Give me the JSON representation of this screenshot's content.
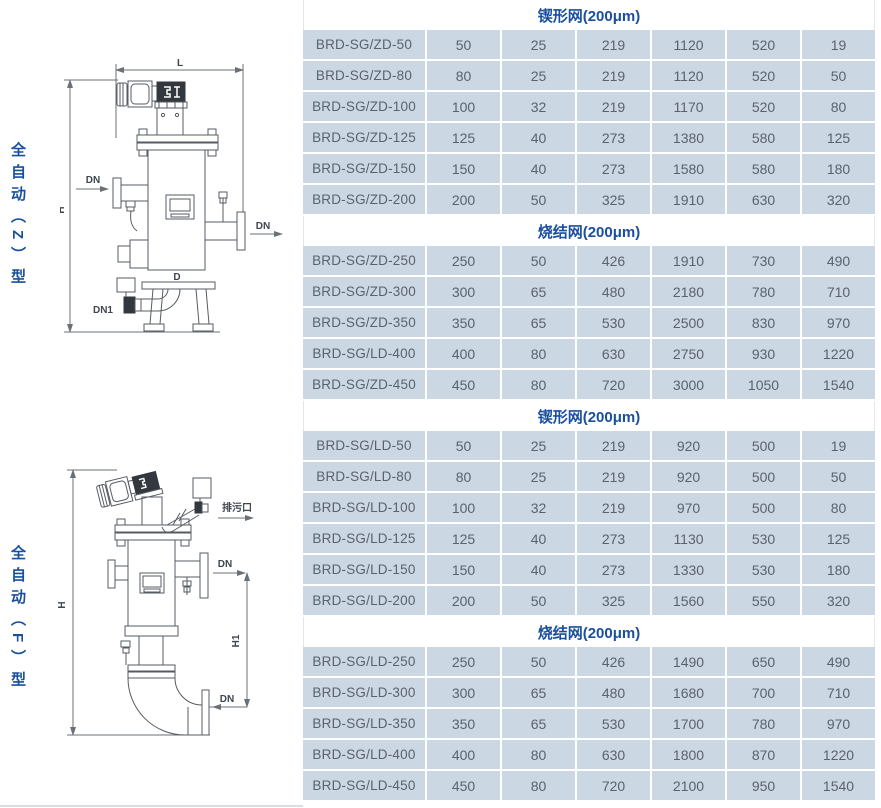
{
  "page": {
    "background": "#ffffff",
    "accent_color": "#1a4f9e",
    "cell_background": "#cbd7e3",
    "cell_text_color": "#5a6270"
  },
  "sidebar": {
    "label_top": "全自动（Z）型",
    "label_bottom": "全自动（F）型"
  },
  "diagram_z": {
    "labels": {
      "L": "L",
      "H": "H",
      "dn_in": "DN",
      "dn_out": "DN",
      "d": "D",
      "dn1": "DN1"
    }
  },
  "diagram_f": {
    "labels": {
      "H": "H",
      "H1": "H1",
      "drain": "排污口",
      "dn_out": "DN",
      "dn_in": "DN"
    }
  },
  "table": {
    "sections": [
      {
        "title": "锲形网(200μm)",
        "rows": [
          {
            "model": "BRD-SG/ZD-50",
            "values": [
              50,
              25,
              219,
              1120,
              520,
              19
            ]
          },
          {
            "model": "BRD-SG/ZD-80",
            "values": [
              80,
              25,
              219,
              1120,
              520,
              50
            ]
          },
          {
            "model": "BRD-SG/ZD-100",
            "values": [
              100,
              32,
              219,
              1170,
              520,
              80
            ]
          },
          {
            "model": "BRD-SG/ZD-125",
            "values": [
              125,
              40,
              273,
              1380,
              580,
              125
            ]
          },
          {
            "model": "BRD-SG/ZD-150",
            "values": [
              150,
              40,
              273,
              1580,
              580,
              180
            ]
          },
          {
            "model": "BRD-SG/ZD-200",
            "values": [
              200,
              50,
              325,
              1910,
              630,
              320
            ]
          }
        ]
      },
      {
        "title": "烧结网(200μm)",
        "rows": [
          {
            "model": "BRD-SG/ZD-250",
            "values": [
              250,
              50,
              426,
              1910,
              730,
              490
            ]
          },
          {
            "model": "BRD-SG/ZD-300",
            "values": [
              300,
              65,
              480,
              2180,
              780,
              710
            ]
          },
          {
            "model": "BRD-SG/ZD-350",
            "values": [
              350,
              65,
              530,
              2500,
              830,
              970
            ]
          },
          {
            "model": "BRD-SG/LD-400",
            "values": [
              400,
              80,
              630,
              2750,
              930,
              1220
            ]
          },
          {
            "model": "BRD-SG/ZD-450",
            "values": [
              450,
              80,
              720,
              3000,
              1050,
              1540
            ]
          }
        ]
      },
      {
        "title": "锲形网(200μm)",
        "rows": [
          {
            "model": "BRD-SG/LD-50",
            "values": [
              50,
              25,
              219,
              920,
              500,
              19
            ]
          },
          {
            "model": "BRD-SG/LD-80",
            "values": [
              80,
              25,
              219,
              920,
              500,
              50
            ]
          },
          {
            "model": "BRD-SG/LD-100",
            "values": [
              100,
              32,
              219,
              970,
              500,
              80
            ]
          },
          {
            "model": "BRD-SG/LD-125",
            "values": [
              125,
              40,
              273,
              1130,
              530,
              125
            ]
          },
          {
            "model": "BRD-SG/LD-150",
            "values": [
              150,
              40,
              273,
              1330,
              530,
              180
            ]
          },
          {
            "model": "BRD-SG/LD-200",
            "values": [
              200,
              50,
              325,
              1560,
              550,
              320
            ]
          }
        ]
      },
      {
        "title": "烧结网(200μm)",
        "rows": [
          {
            "model": "BRD-SG/LD-250",
            "values": [
              250,
              50,
              426,
              1490,
              650,
              490
            ]
          },
          {
            "model": "BRD-SG/LD-300",
            "values": [
              300,
              65,
              480,
              1680,
              700,
              710
            ]
          },
          {
            "model": "BRD-SG/LD-350",
            "values": [
              350,
              65,
              530,
              1700,
              780,
              970
            ]
          },
          {
            "model": "BRD-SG/LD-400",
            "values": [
              400,
              80,
              630,
              1800,
              870,
              1220
            ]
          },
          {
            "model": "BRD-SG/LD-450",
            "values": [
              450,
              80,
              720,
              2100,
              950,
              1540
            ]
          }
        ]
      }
    ]
  }
}
